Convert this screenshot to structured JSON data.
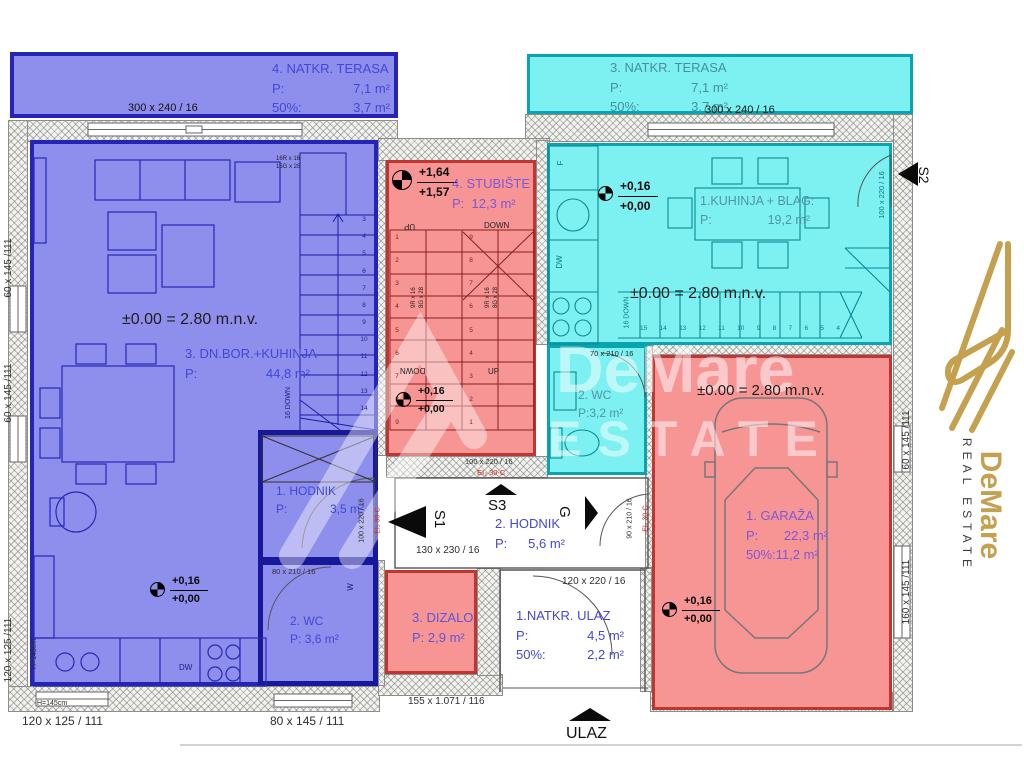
{
  "terrace4": {
    "name": "4. NATKR. TERASA",
    "p_label": "P:",
    "p_value": "7,1 m²",
    "pct_label": "50%:",
    "pct_value": "3,7 m²",
    "dim": "300 x 240 / 16"
  },
  "terrace3": {
    "name": "3. NATKR. TERASA",
    "p_label": "P:",
    "p_value": "7,1 m²",
    "pct_label": "50%:",
    "pct_value": "3,7 m²",
    "dim": "300 x 240 / 16"
  },
  "living": {
    "level": "±0.00 = 2.80 m.n.v.",
    "name": "3. DN.BOR.+KUHINJA",
    "p_label": "P:",
    "p_value": "44,8 m²",
    "lvl_hi": "+0,16",
    "lvl_lo": "+0,00",
    "dw": "DW",
    "stair_spec_r": "16R x 16",
    "stair_spec_g": "15G x 28",
    "stair_down": "16 DOWN",
    "steps": [
      "3",
      "4",
      "5",
      "6",
      "7",
      "8",
      "9",
      "10",
      "11",
      "12",
      "13",
      "14"
    ]
  },
  "stairwell": {
    "name": "4. STUBIŠTE",
    "p_label": "P:",
    "p_value": "12,3 m²",
    "lvl_hi": "+1,64",
    "lvl_lo": "+1,57",
    "lvl2_hi": "+0,16",
    "lvl2_lo": "+0,00",
    "up": "UP",
    "down": "DOWN",
    "spec_r": "9R x 16",
    "spec_g": "8G x 28",
    "steps_left": [
      "1",
      "2",
      "3",
      "4",
      "5",
      "6",
      "7",
      "8",
      "9"
    ],
    "steps_right": [
      "9",
      "8",
      "7",
      "6",
      "5",
      "4",
      "3",
      "2",
      "1"
    ]
  },
  "hodnik1": {
    "name": "1. HODNIK",
    "p_label": "P:",
    "p_value": "3,5 m²"
  },
  "wc_blue": {
    "name": "2. WC",
    "p_label": "P:",
    "p_value": "3,6 m²",
    "door_dim": "80 x 210 / 16",
    "w": "W"
  },
  "dizalo": {
    "name": "3. DIZALO",
    "p_label": "P:",
    "p_value": "2,9 m²"
  },
  "hodnik2": {
    "name": "2. HODNIK",
    "p_label": "P:",
    "p_value": "5,6 m²",
    "s1": "S1",
    "s3": "S3",
    "g": "G",
    "dim_s1": "130 x 230 / 16",
    "dim_s3": "100 x 220 / 16",
    "dim_s1_v": "100 x 220 / 16",
    "dim_g_v": "90 x 210 / 16",
    "fire": "EI₂ 30-C"
  },
  "ulaz_room": {
    "name": "1.NATKR. ULAZ",
    "p_label": "P:",
    "p_value": "4,5 m²",
    "pct_label": "50%:",
    "pct_value": "2,2 m²",
    "door_dim": "120 x 220 / 16"
  },
  "kitchen": {
    "name": "1.KUHINJA + BLAG:",
    "p_label": "P:",
    "p_value": "19,2 m²",
    "level": "±0.00 = 2.80 m.n.v.",
    "lvl_hi": "+0,16",
    "lvl_lo": "+0,00",
    "f": "F",
    "dw": "DW",
    "dim_window": "100 x 220 / 16",
    "stair_down": "16 DOWN",
    "steps": [
      "15",
      "14",
      "13",
      "12",
      "11",
      "10",
      "9",
      "8",
      "7",
      "6",
      "5",
      "4"
    ]
  },
  "wc_cyan": {
    "name": "2. WC",
    "p_label": "P:",
    "p_value": "3,2 m²",
    "door_dim": "70 x 210 / 16"
  },
  "garage": {
    "name": "1. GARAŽA",
    "p_label": "P:",
    "p_value": "22,3 m²",
    "pct_label": "50%:",
    "pct_value": "11,2 m²",
    "level": "±0.00 = 2.80 m.n.v.",
    "lvl_hi": "+0,16",
    "lvl_lo": "+0,00"
  },
  "entrance": {
    "label": "ULAZ"
  },
  "dims": {
    "bottom_mid": "155 x 1.071 / 116",
    "bottom_left": "120 x 125 / 111",
    "bottom_center": "80 x 145 / 111",
    "sill": "H=145cm",
    "left_top": "60 x 145 /111",
    "left_mid": "60 x 145 /111",
    "left_bottom": "120 x 125 /111",
    "right_top": "60 x 145 /111",
    "right_bottom": "160 x 145 /111",
    "s2": "S2"
  },
  "logo": {
    "brand": "DeMare",
    "tagline": "REAL ESTATE"
  },
  "watermark": {
    "line1": "DeMare",
    "line2": "ESTATE"
  }
}
